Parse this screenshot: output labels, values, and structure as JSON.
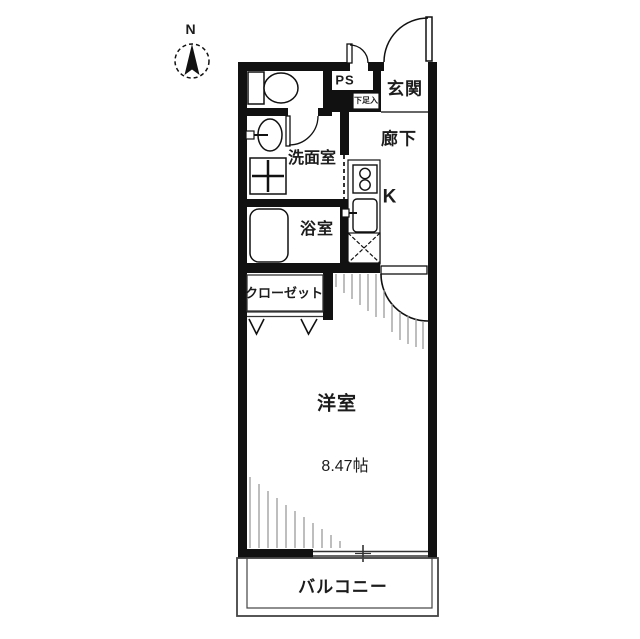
{
  "title": "apartment-floor-plan",
  "compass": {
    "north_label": "N"
  },
  "rooms": {
    "entrance": "玄関",
    "hallway": "廊下",
    "pipe_space": "PS",
    "shoe_box": "下足入",
    "washroom": "洗面室",
    "bathroom": "浴室",
    "kitchen": "K",
    "closet": "クローゼット",
    "western_room": "洋室",
    "western_room_size": "8.47帖",
    "balcony": "バルコニー"
  },
  "colors": {
    "wall": "#111111",
    "line": "#333333",
    "hatch": "#9a9a9a",
    "background": "#ffffff"
  }
}
